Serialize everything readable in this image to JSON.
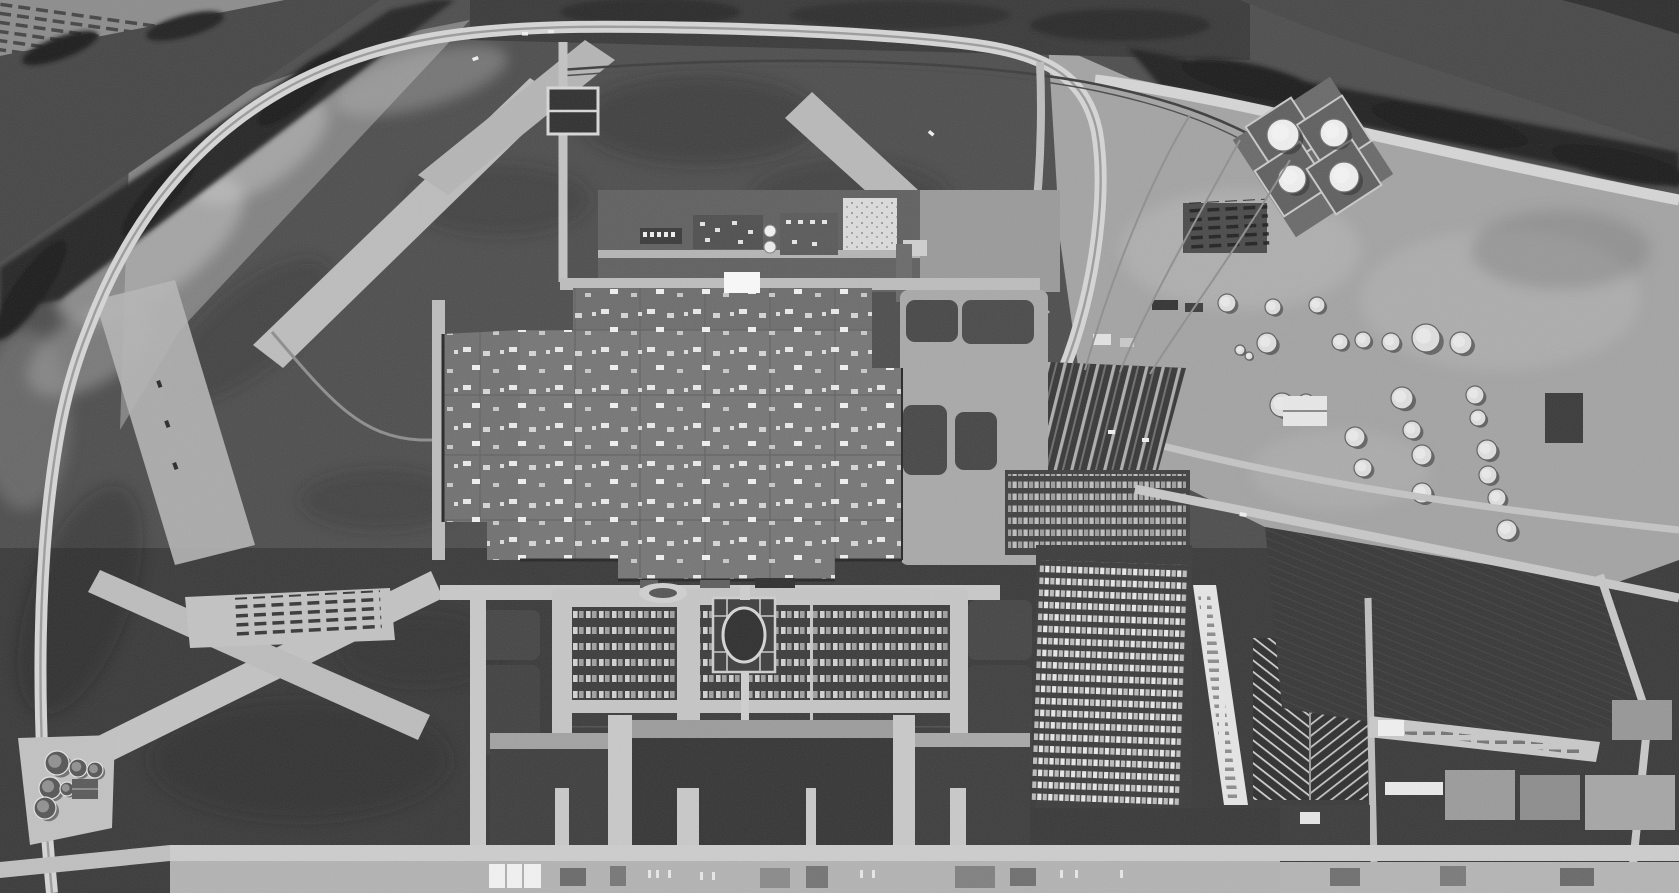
{
  "scene": {
    "title": "Black-and-white aerial photograph of a large automobile assembly plant, tank farm and rail yard on a riverside industrial site ringed by an oval test track",
    "style": "monochrome aerial photograph, high oblique-vertical view, mid-century",
    "features": {
      "river": "river crossing the upper-left and upper-right corners",
      "tree_line": "dark tree bands along both river banks",
      "test_track": "light oval perimeter road around the former airfield",
      "runways": "abandoned light concrete runways crossing the grass airfield",
      "assembly_plant": "huge gray factory roof dotted with white rooftop vents",
      "powerhouse": "utility buildings, cooling cells and white yard north of the plant",
      "settling_basins": "two dark rectangular water basins with light rims",
      "tank_farm": "circular oil storage tanks, four large tanks in diamond berms",
      "rail_yard": "fan of parallel railroad sidings with cars",
      "employee_parking": "three large car-filled parking lots fronting the plant",
      "formal_garden": "oval landscaped garden with radiating paths at plant entrance",
      "vehicle_storage": "new-vehicle marshalling lots and white loading lane with car-hauler rows",
      "sewage_plant": "cluster of six circular clarifier tanks in the lower-left corner",
      "highway_strip": "light frontage road with small commercial buildings along the bottom",
      "warehouses": "flat-roofed warehouse blocks in the lower-right corner",
      "farm_field": "dark furrowed field on the right side"
    },
    "palette": {
      "water": "#464646",
      "trees": "#212121",
      "dark_grass": "#3a3a3a",
      "airfield_grass": "#4e4e4e",
      "light_ground": "#a4a4a4",
      "road": "#d6d6d6",
      "runway": "#bdbdbd",
      "factory_roof": "#767676",
      "tank_white": "#efefef",
      "asphalt_lot": "#3c3c3c"
    },
    "big_tanks": [
      [
        1283,
        135,
        16
      ],
      [
        1334,
        133,
        14
      ],
      [
        1292,
        179,
        14
      ],
      [
        1344,
        177,
        15
      ]
    ],
    "small_tanks": [
      [
        1267,
        343,
        10
      ],
      [
        1340,
        342,
        8
      ],
      [
        1363,
        340,
        8
      ],
      [
        1391,
        342,
        9
      ],
      [
        1426,
        338,
        14
      ],
      [
        1461,
        343,
        11
      ],
      [
        1282,
        405,
        12
      ],
      [
        1306,
        402,
        8
      ],
      [
        1402,
        398,
        11
      ],
      [
        1475,
        395,
        9
      ],
      [
        1355,
        437,
        10
      ],
      [
        1412,
        430,
        9
      ],
      [
        1478,
        418,
        8
      ],
      [
        1363,
        468,
        9
      ],
      [
        1422,
        455,
        10
      ],
      [
        1487,
        450,
        10
      ],
      [
        1488,
        475,
        9
      ],
      [
        1422,
        493,
        10
      ],
      [
        1497,
        498,
        9
      ],
      [
        1507,
        530,
        10
      ],
      [
        1227,
        303,
        9
      ],
      [
        1273,
        307,
        8
      ],
      [
        1317,
        305,
        8
      ],
      [
        1240,
        350,
        5
      ],
      [
        1249,
        356,
        4
      ]
    ],
    "clarifiers": [
      [
        57,
        763,
        12
      ],
      [
        78,
        768,
        9
      ],
      [
        95,
        770,
        8
      ],
      [
        50,
        788,
        11
      ],
      [
        67,
        789,
        7
      ],
      [
        45,
        808,
        11
      ]
    ],
    "counts": {
      "large_storage_tanks": 4,
      "small_storage_tanks": 25,
      "treatment_clarifiers": 6,
      "parking_lots": 3
    }
  }
}
